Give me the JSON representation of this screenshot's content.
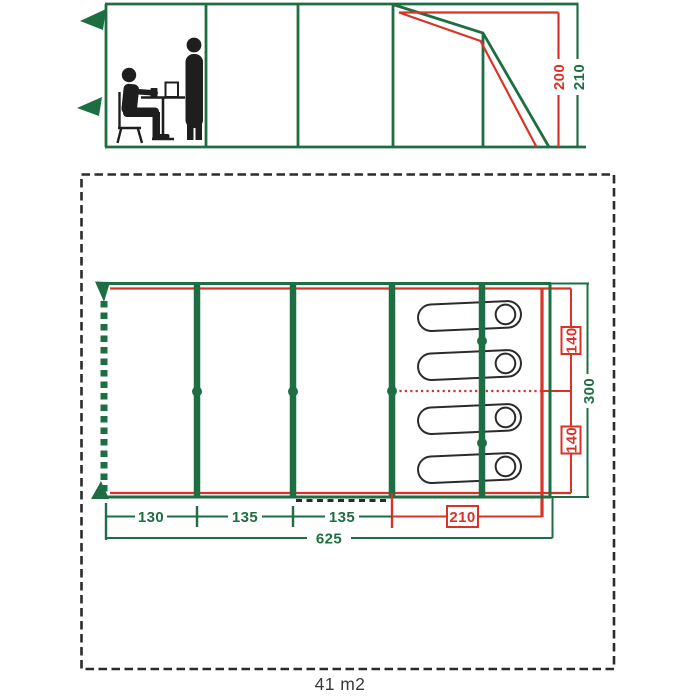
{
  "colors": {
    "green": "#1d6f43",
    "red": "#d93327",
    "ink": "#1e1e1e",
    "border": "#2b2b2b"
  },
  "elevation": {
    "dims": {
      "peak_height": "200",
      "total_height": "210"
    },
    "figures": [
      "person-sitting-icon",
      "table-icon",
      "person-standing-icon"
    ]
  },
  "floor": {
    "dims": {
      "segments": [
        "130",
        "135",
        "135"
      ],
      "bedroom_length": "210",
      "total_length": "625",
      "width": "300",
      "bed_widths": [
        "140",
        "140"
      ]
    },
    "area": "41 m2",
    "sleeping_pods": 4,
    "poles": 4
  }
}
